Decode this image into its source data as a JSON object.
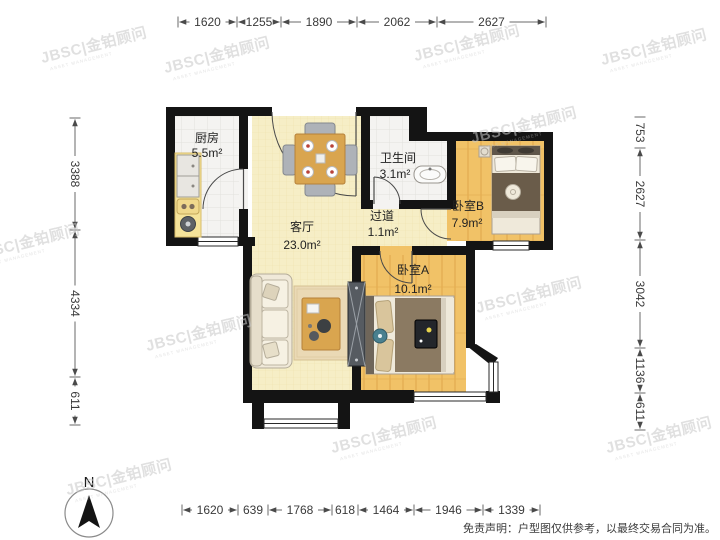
{
  "floorplan": {
    "rooms": [
      {
        "name": "厨房",
        "area": "5.5m²"
      },
      {
        "name": "客厅",
        "area": "23.0m²"
      },
      {
        "name": "卫生间",
        "area": "3.1m²"
      },
      {
        "name": "过道",
        "area": "1.1m²"
      },
      {
        "name": "卧室B",
        "area": "7.9m²"
      },
      {
        "name": "卧室A",
        "area": "10.1m²"
      }
    ],
    "dimensions_mm": {
      "top": [
        "1620",
        "1255",
        "1890",
        "2062",
        "2627"
      ],
      "bottom": [
        "1620",
        "639",
        "1768",
        "618",
        "1464",
        "1946",
        "1339"
      ],
      "left": [
        "3388",
        "4334",
        "611"
      ],
      "right": [
        "753",
        "2627",
        "3042",
        "1136",
        "611"
      ]
    },
    "compass_label": "N",
    "watermark": {
      "text": "JBSC|金铂顾问",
      "subtext": "ASSET MANAGEMENT"
    },
    "disclaimer": "免责声明：户型图仅供参考，以最终交易合同为准。",
    "colors": {
      "wall": "#141414",
      "living_floor": "#f6eec6",
      "wood_floor": "#f1c267",
      "tile_floor": "#f4f3f1",
      "counter": "#f5e39a",
      "table_wood": "#d9a54f",
      "watermark": "#c8c8c8"
    }
  }
}
